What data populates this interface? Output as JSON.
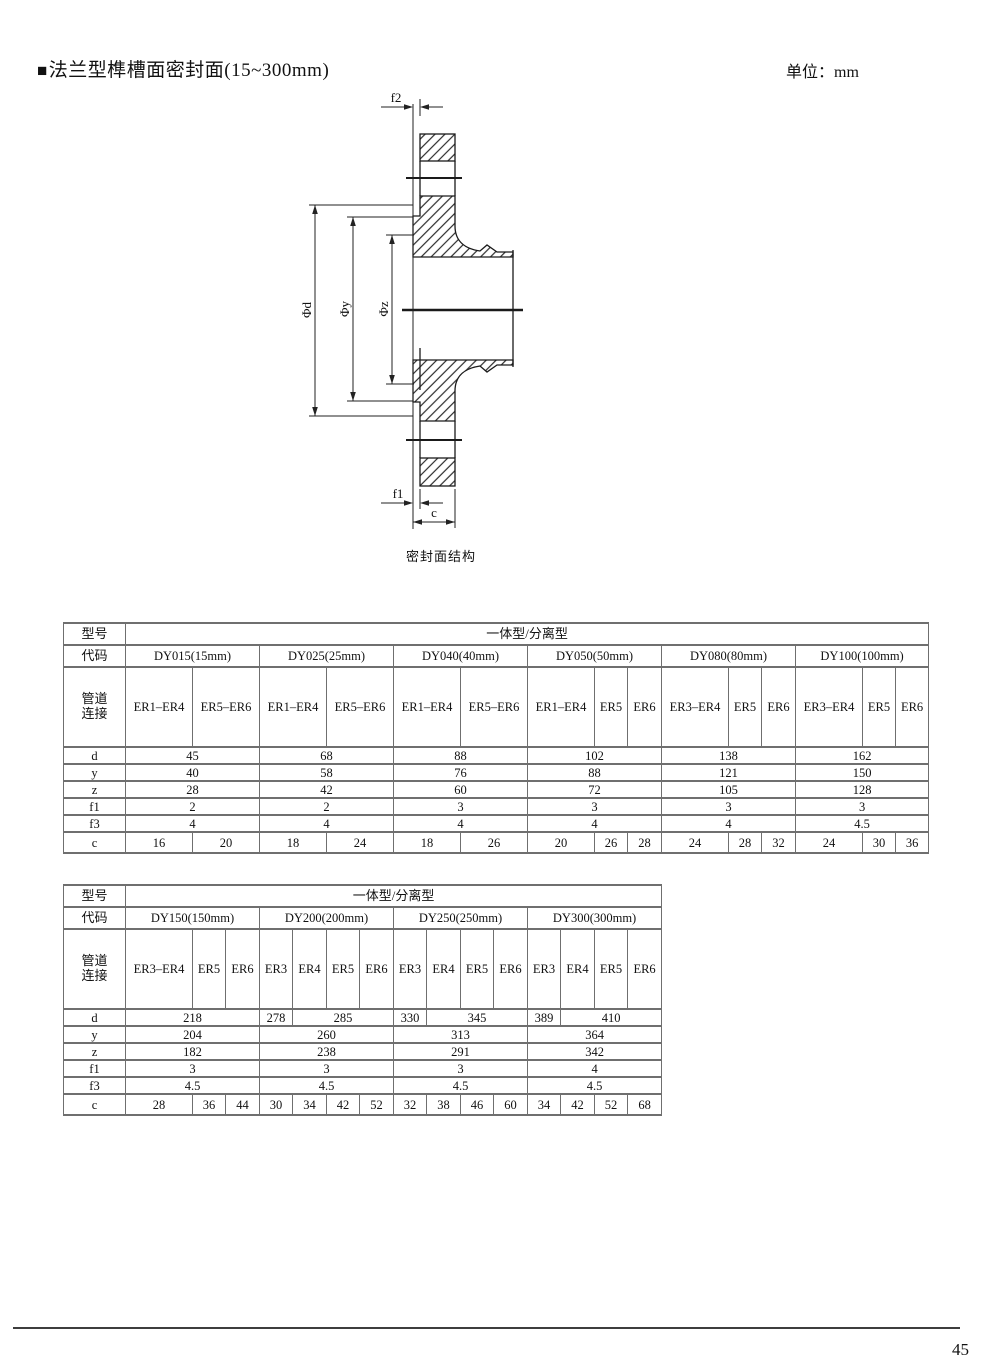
{
  "page": {
    "bullet": "■",
    "title": "法兰型榫槽面密封面(15~300mm)",
    "unit": "单位：mm",
    "number": "45"
  },
  "drawing": {
    "caption": "密封面结构",
    "dim_f2": "f2",
    "dim_f1": "f1",
    "dim_c": "c",
    "dim_d": "Φd",
    "dim_y": "Φy",
    "dim_z": "Φz"
  },
  "t1": {
    "model_label": "型号",
    "code_label": "代码",
    "pipe_label1": "管道",
    "pipe_label2": "连接",
    "type_span": "一体型/分离型",
    "codes": [
      "DY015(15mm)",
      "DY025(25mm)",
      "DY040(40mm)",
      "DY050(50mm)",
      "DY080(80mm)",
      "DY100(100mm)"
    ],
    "pipes": [
      "ER1–ER4",
      "ER5–ER6",
      "ER1–ER4",
      "ER5–ER6",
      "ER1–ER4",
      "ER5–ER6",
      "ER1–ER4",
      "ER5",
      "ER6",
      "ER3–ER4",
      "ER5",
      "ER6",
      "ER3–ER4",
      "ER5",
      "ER6"
    ],
    "labels": {
      "d": "d",
      "y": "y",
      "z": "z",
      "f1": "f1",
      "f3": "f3",
      "c": "c"
    },
    "d": [
      "45",
      "68",
      "88",
      "102",
      "138",
      "162"
    ],
    "y": [
      "40",
      "58",
      "76",
      "88",
      "121",
      "150"
    ],
    "z": [
      "28",
      "42",
      "60",
      "72",
      "105",
      "128"
    ],
    "f1": [
      "2",
      "2",
      "3",
      "3",
      "3",
      "3"
    ],
    "f3": [
      "4",
      "4",
      "4",
      "4",
      "4",
      "4.5"
    ],
    "c": [
      "16",
      "20",
      "18",
      "24",
      "18",
      "26",
      "20",
      "26",
      "28",
      "24",
      "28",
      "32",
      "24",
      "30",
      "36"
    ]
  },
  "t2": {
    "model_label": "型号",
    "code_label": "代码",
    "pipe_label1": "管道",
    "pipe_label2": "连接",
    "type_span": "一体型/分离型",
    "codes": [
      "DY150(150mm)",
      "DY200(200mm)",
      "DY250(250mm)",
      "DY300(300mm)"
    ],
    "pipes": [
      "ER3–ER4",
      "ER5",
      "ER6",
      "ER3",
      "ER4",
      "ER5",
      "ER6",
      "ER3",
      "ER4",
      "ER5",
      "ER6",
      "ER3",
      "ER4",
      "ER5",
      "ER6"
    ],
    "labels": {
      "d": "d",
      "y": "y",
      "z": "z",
      "f1": "f1",
      "f3": "f3",
      "c": "c"
    },
    "d": [
      "218",
      "278",
      "285",
      "330",
      "345",
      "389",
      "410"
    ],
    "y": [
      "204",
      "260",
      "313",
      "364"
    ],
    "z": [
      "182",
      "238",
      "291",
      "342"
    ],
    "f1": [
      "3",
      "3",
      "3",
      "4"
    ],
    "f3": [
      "4.5",
      "4.5",
      "4.5",
      "4.5"
    ],
    "c": [
      "28",
      "36",
      "44",
      "30",
      "34",
      "42",
      "52",
      "32",
      "38",
      "46",
      "60",
      "34",
      "42",
      "52",
      "68"
    ]
  }
}
